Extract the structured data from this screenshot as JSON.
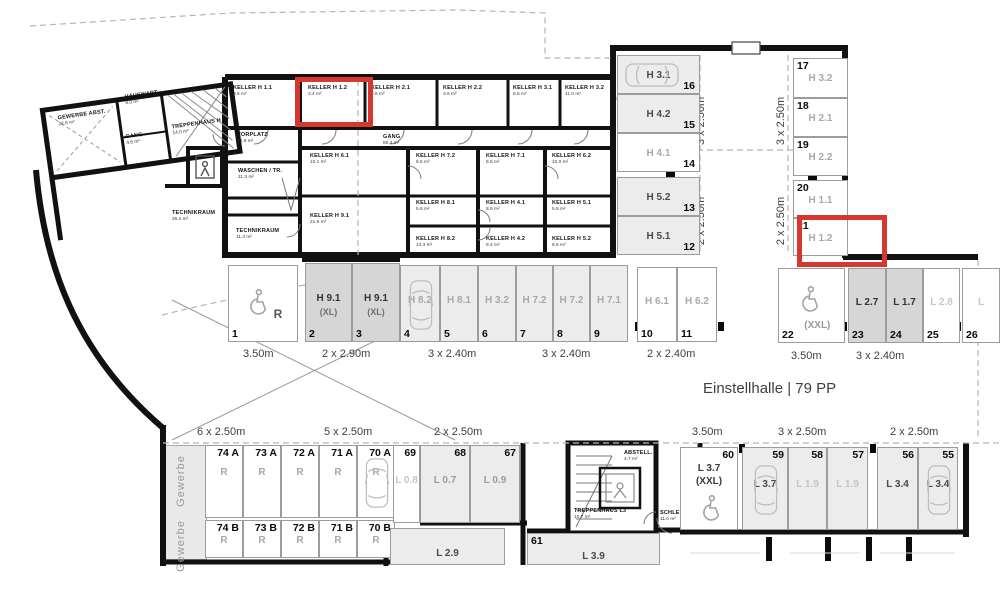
{
  "title": "Einstellhalle | 79 PP",
  "accent": "#d6382d",
  "rooms": {
    "gewerbe_abst": {
      "name": "GEWERBE ABST.",
      "area": "22.6 m²"
    },
    "hauswart": {
      "name": "HAUSWART",
      "area": "8.0 m²"
    },
    "gang_small": {
      "name": "GANG",
      "area": "4.6 m²"
    },
    "treppenhaus_h": {
      "name": "TREPPENHAUS H",
      "area": "14.0 m²"
    },
    "vorplatz": {
      "name": "VORPLATZ",
      "area": "13.8 m²"
    },
    "waschen_tr": {
      "name": "WASCHEN / TR.",
      "area": "11.3 m²"
    },
    "technikraum_1": {
      "name": "TECHNIKRAUM",
      "area": "26.2 m²"
    },
    "technikraum_2": {
      "name": "TECHNIKRAUM",
      "area": "11.3 m²"
    },
    "gang_long": {
      "name": "GANG",
      "area": "80.4 m²"
    },
    "abstell": {
      "name": "ABSTELL.",
      "area": "4.7 m²"
    },
    "treppenhaus_l3": {
      "name": "TREPPENHAUS L3",
      "area": "10.7 m²"
    },
    "schleuse": {
      "name": "SCHLEUSE",
      "area": "11.0 m²"
    }
  },
  "kellers": {
    "top": [
      {
        "name": "KELLER H 1.1",
        "area": "3.6 m²"
      },
      {
        "name": "KELLER H 1.2",
        "area": "3.4 m²"
      },
      {
        "name": "KELLER H 2.1",
        "area": "3.6 m²"
      },
      {
        "name": "KELLER H 2.2",
        "area": "3.6 m²"
      },
      {
        "name": "KELLER H 3.1",
        "area": "5.6 m²"
      },
      {
        "name": "KELLER H 3.2",
        "area": "11.0 m²"
      }
    ],
    "row1": [
      {
        "name": "KELLER H 6.1",
        "area": "10.1 m²"
      },
      {
        "name": "KELLER H 7.2",
        "area": "8.6 m²"
      },
      {
        "name": "KELLER H 7.1",
        "area": "8.5 m²"
      },
      {
        "name": "KELLER H 6.2",
        "area": "10.0 m²"
      }
    ],
    "row2": [
      {
        "name": "KELLER H 8.1",
        "area": "5.6 m²"
      },
      {
        "name": "KELLER H 4.1",
        "area": "8.5 m²"
      },
      {
        "name": "KELLER H 5.1",
        "area": "5.5 m²"
      }
    ],
    "row3": [
      {
        "name": "KELLER H 8.2",
        "area": "13.3 m²"
      },
      {
        "name": "KELLER H 4.2",
        "area": "9.4 m²"
      },
      {
        "name": "KELLER H 5.2",
        "area": "8.6 m²"
      }
    ],
    "h91": {
      "name": "KELLER H 9.1",
      "area": "21.9 m²"
    }
  },
  "stalls": {
    "main_row": [
      {
        "no": "1",
        "label": "R",
        "icon": "wheelchair"
      },
      {
        "no": "2",
        "label": "H 9.1",
        "sub": "(XL)",
        "shade": "dark"
      },
      {
        "no": "3",
        "label": "H 9.1",
        "sub": "(XL)",
        "shade": "dark"
      },
      {
        "no": "4",
        "label": "H 8.2",
        "icon": "car-v",
        "shade": "light"
      },
      {
        "no": "5",
        "label": "H 8.1",
        "shade": "light"
      },
      {
        "no": "6",
        "label": "H 3.2",
        "shade": "light"
      },
      {
        "no": "7",
        "label": "H 7.2",
        "shade": "light"
      },
      {
        "no": "8",
        "label": "H 7.2",
        "shade": "light"
      },
      {
        "no": "9",
        "label": "H 7.1",
        "shade": "light"
      },
      {
        "no": "10",
        "label": "H 6.1"
      },
      {
        "no": "11",
        "label": "H 6.2"
      }
    ],
    "left_col": [
      {
        "no": "16",
        "label": "H 3.1",
        "icon": "car-h",
        "shade": "light"
      },
      {
        "no": "15",
        "label": "H 4.2",
        "shade": "light"
      },
      {
        "no": "14",
        "label": "H 4.1"
      },
      {
        "no": "13",
        "label": "H 5.2",
        "shade": "light"
      },
      {
        "no": "12",
        "label": "H 5.1",
        "shade": "light"
      }
    ],
    "right_col": [
      {
        "no": "17",
        "label": "H 3.2"
      },
      {
        "no": "18",
        "label": "H 2.1"
      },
      {
        "no": "19",
        "label": "H 2.2"
      },
      {
        "no": "20",
        "label": "H 1.1"
      },
      {
        "no": "21",
        "label": "H 1.2",
        "highlighted": true
      }
    ],
    "right_row": [
      {
        "no": "22",
        "sub": "(XXL)",
        "icon": "wheelchair"
      },
      {
        "no": "23",
        "label": "L 2.7",
        "shade": "dark"
      },
      {
        "no": "24",
        "label": "L 1.7",
        "shade": "dark"
      },
      {
        "no": "25",
        "label": "L 2.8",
        "faint": true
      },
      {
        "no": "26",
        "label": "L",
        "faint": true
      }
    ],
    "bottom_a": [
      {
        "no": "74 A",
        "label": "R"
      },
      {
        "no": "73 A",
        "label": "R"
      },
      {
        "no": "72 A",
        "label": "R"
      },
      {
        "no": "71 A",
        "label": "R"
      },
      {
        "no": "70 A",
        "label": "R",
        "icon": "car-v"
      }
    ],
    "bottom_b": [
      {
        "no": "74 B",
        "label": "R"
      },
      {
        "no": "73 B",
        "label": "R"
      },
      {
        "no": "72 B",
        "label": "R"
      },
      {
        "no": "71 B",
        "label": "R"
      },
      {
        "no": "70 B",
        "label": "R"
      }
    ],
    "bottom_mid": [
      {
        "no": "69",
        "label": "L 0.8",
        "faint": true
      },
      {
        "no": "68",
        "label": "L 0.7",
        "shade": "light"
      },
      {
        "no": "67",
        "label": "L 0.9",
        "shade": "light"
      }
    ],
    "bottom_cut": [
      {
        "no": "",
        "label": "L 2.9",
        "shade": "light"
      },
      {
        "no": "61",
        "label": "L 3.9",
        "shade": "light"
      }
    ],
    "bottom_right": [
      {
        "no": "60",
        "label": "L 3.7",
        "sub": "(XXL)",
        "icon": "wheelchair"
      },
      {
        "no": "59",
        "label": "L 3.7",
        "icon": "car-v",
        "shade": "light"
      },
      {
        "no": "58",
        "label": "L 1.9",
        "shade": "light",
        "faint": true
      },
      {
        "no": "57",
        "label": "L 1.9",
        "shade": "light",
        "faint": true
      },
      {
        "no": "56",
        "label": "L 3.4",
        "shade": "light"
      },
      {
        "no": "55",
        "label": "L 3.4",
        "icon": "car-v",
        "shade": "light"
      }
    ]
  },
  "dimensions": {
    "main_row": [
      "3.50m",
      "2 x 2.90m",
      "3 x 2.40m",
      "3 x 2.40m",
      "2 x 2.40m"
    ],
    "right_row": [
      "3.50m",
      "3 x 2.40m"
    ],
    "vertical": [
      "3 x 2.50m",
      "3 x 2.50m",
      "2 x 2.50m",
      "2 x 2.50m"
    ],
    "bottom": [
      "6 x 2.50m",
      "5 x 2.50m",
      "2 x 2.50m",
      "3.50m",
      "3 x 2.50m",
      "2 x 2.50m"
    ]
  },
  "zones": {
    "gewerbe_top": "Gewerbe",
    "gewerbe_bottom": "Gewerbe"
  }
}
